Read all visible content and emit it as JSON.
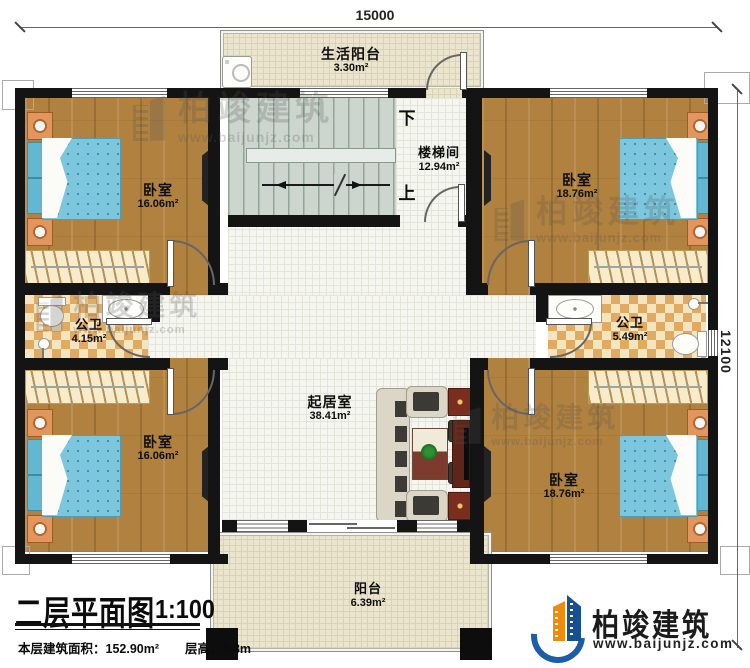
{
  "meta": {
    "plan_title": "二层平面图",
    "scale": "1:100",
    "floor_area": "本层建筑面积：152.90m²",
    "floor_height": "层高：3.3m"
  },
  "dimensions": {
    "top": "15000",
    "right": "12100"
  },
  "rooms": {
    "life_balcony": {
      "name": "生活阳台",
      "area": "3.30m²"
    },
    "stairwell": {
      "name": "楼梯间",
      "area": "12.94m²",
      "down_label": "下",
      "up_label": "上"
    },
    "bedroom_top_left": {
      "name": "卧室",
      "area": "16.06m²"
    },
    "bedroom_top_right": {
      "name": "卧室",
      "area": "18.76m²"
    },
    "bathroom_left": {
      "name": "公卫",
      "area": "4.15m²"
    },
    "bathroom_right": {
      "name": "公卫",
      "area": "5.49m²"
    },
    "living_room": {
      "name": "起居室",
      "area": "38.41m²"
    },
    "bedroom_bottom_left": {
      "name": "卧室",
      "area": "16.06m²"
    },
    "bedroom_bottom_right": {
      "name": "卧室",
      "area": "18.76m²"
    },
    "balcony": {
      "name": "阳台",
      "area": "6.39m²"
    }
  },
  "branding": {
    "company": "柏竣建筑",
    "website": "www.baijunjz.com"
  },
  "watermark": {
    "text": "柏竣建筑",
    "url": "www.baijunjz.com"
  },
  "colors": {
    "wall": "#141414",
    "wood": "#b0813f",
    "checker": "#e0aa61",
    "bed": "#7cc7de",
    "stairs": "#cdd6ce",
    "balcony": "#eae5cc",
    "logo_blue": "#1b5ea6",
    "logo_orange": "#ef8c0d"
  }
}
